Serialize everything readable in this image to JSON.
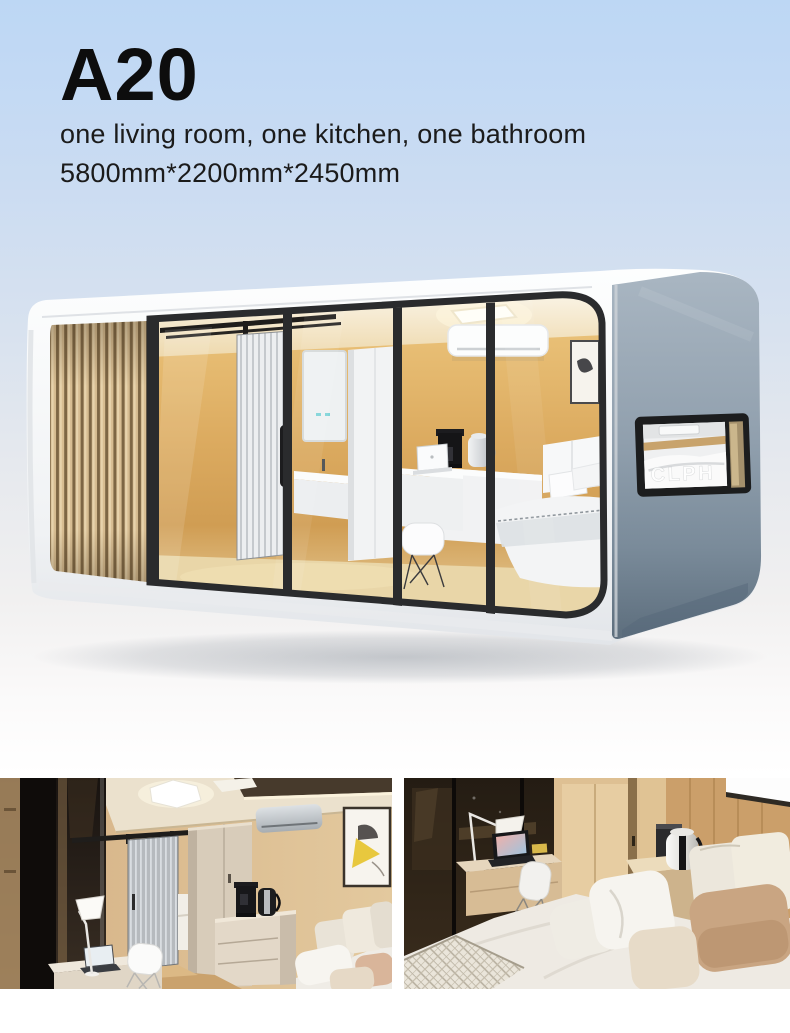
{
  "product": {
    "model": "A20",
    "layout_description": "one living room, one kitchen, one bathroom",
    "dimensions": "5800mm*2200mm*2450mm"
  },
  "hero": {
    "window_letters": "CLPH",
    "description": "white capsule cabin render with wood slat end, black-framed glass front showing bathroom, desk and bed, gray end panel with horizontal window"
  },
  "gallery": {
    "left_label": "interior view: desk, barn door, wardrobe, kettle, air conditioner, bed corner",
    "right_label": "interior view: bed with pillows, desk with lamp and laptop, kettle counter"
  },
  "colors": {
    "sky_top": "#bdd7f4",
    "shell_white": "#f7f8f9",
    "wood_slat": "#d7bd92",
    "glass_amber": "#d4a55c",
    "frame_black": "#2a2b2d",
    "side_gray": "#91a0ae",
    "interior_tan": "#d9b88a",
    "bedding_white": "#efece6",
    "text_dark": "#0d0d0d"
  }
}
